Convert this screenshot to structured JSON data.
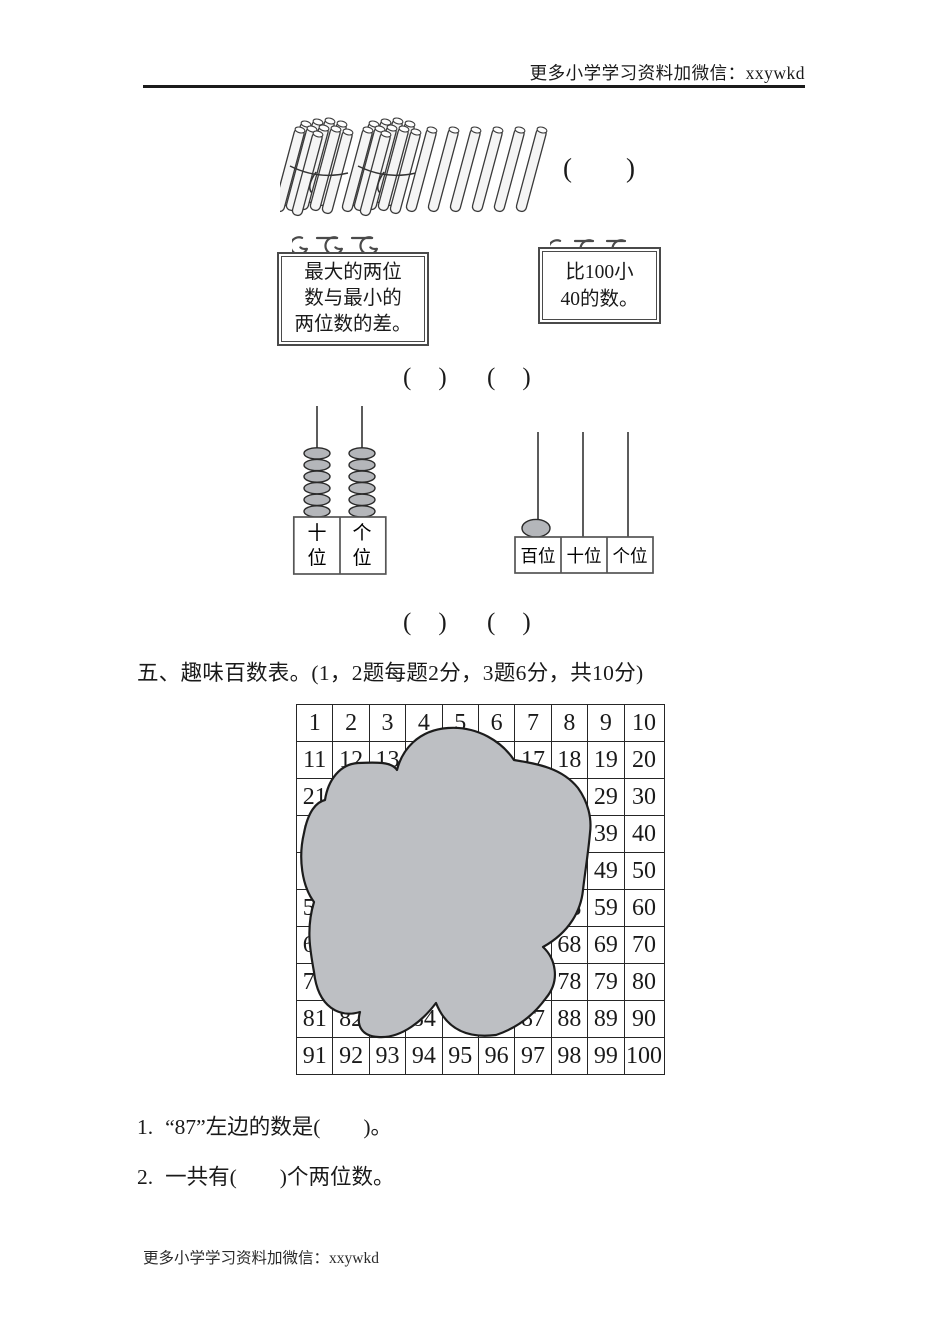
{
  "page": {
    "background": "#ffffff",
    "ink": "#1a1a1a",
    "cloud_color": "#bdbfc3",
    "stick_fill": "#f5f5f5",
    "bead_fill": "#b4b6ba"
  },
  "header": {
    "promo_text": "更多小学学习资料加微信：xxywkd"
  },
  "footer": {
    "promo_text": "更多小学学习资料加微信：xxywkd"
  },
  "sticks_item": {
    "bundle_count": 2,
    "sticks_per_bundle": 10,
    "loose_sticks": 6,
    "answer_blank": "(　　)"
  },
  "boards": [
    {
      "lines": [
        "最大的两位",
        "数与最小的",
        "两位数的差。"
      ]
    },
    {
      "lines": [
        "比100小",
        "40的数。"
      ]
    }
  ],
  "board_answer_blanks": [
    "(　)",
    "(　)"
  ],
  "abacus_left": {
    "columns": [
      {
        "label_top": "十",
        "label_bottom": "位",
        "beads": 6
      },
      {
        "label_top": "个",
        "label_bottom": "位",
        "beads": 6
      }
    ]
  },
  "abacus_right": {
    "columns": [
      {
        "label": "百位",
        "beads": 1
      },
      {
        "label": "十位",
        "beads": 0
      },
      {
        "label": "个位",
        "beads": 0
      }
    ]
  },
  "abacus_answer_blanks": [
    "(　)",
    "(　)"
  ],
  "section_five": {
    "title": "五、趣味百数表。(1，2题每题2分，3题6分，共10分)"
  },
  "hundred_table": {
    "rows": [
      [
        1,
        2,
        3,
        4,
        5,
        6,
        7,
        8,
        9,
        10
      ],
      [
        11,
        12,
        13,
        14,
        15,
        16,
        17,
        18,
        19,
        20
      ],
      [
        21,
        22,
        23,
        24,
        25,
        26,
        27,
        28,
        29,
        30
      ],
      [
        31,
        32,
        33,
        34,
        35,
        36,
        37,
        38,
        39,
        40
      ],
      [
        41,
        42,
        43,
        44,
        45,
        46,
        47,
        48,
        49,
        50
      ],
      [
        51,
        52,
        53,
        54,
        55,
        56,
        57,
        58,
        59,
        60
      ],
      [
        61,
        62,
        63,
        64,
        65,
        66,
        67,
        68,
        69,
        70
      ],
      [
        71,
        72,
        73,
        74,
        75,
        76,
        77,
        78,
        79,
        80
      ],
      [
        81,
        82,
        83,
        84,
        85,
        86,
        87,
        88,
        89,
        90
      ],
      [
        91,
        92,
        93,
        94,
        95,
        96,
        97,
        98,
        99,
        100
      ]
    ]
  },
  "questions": [
    {
      "num": "1.",
      "text": "“87”左边的数是(　　)。"
    },
    {
      "num": "2.",
      "text": "一共有(　　)个两位数。"
    }
  ]
}
